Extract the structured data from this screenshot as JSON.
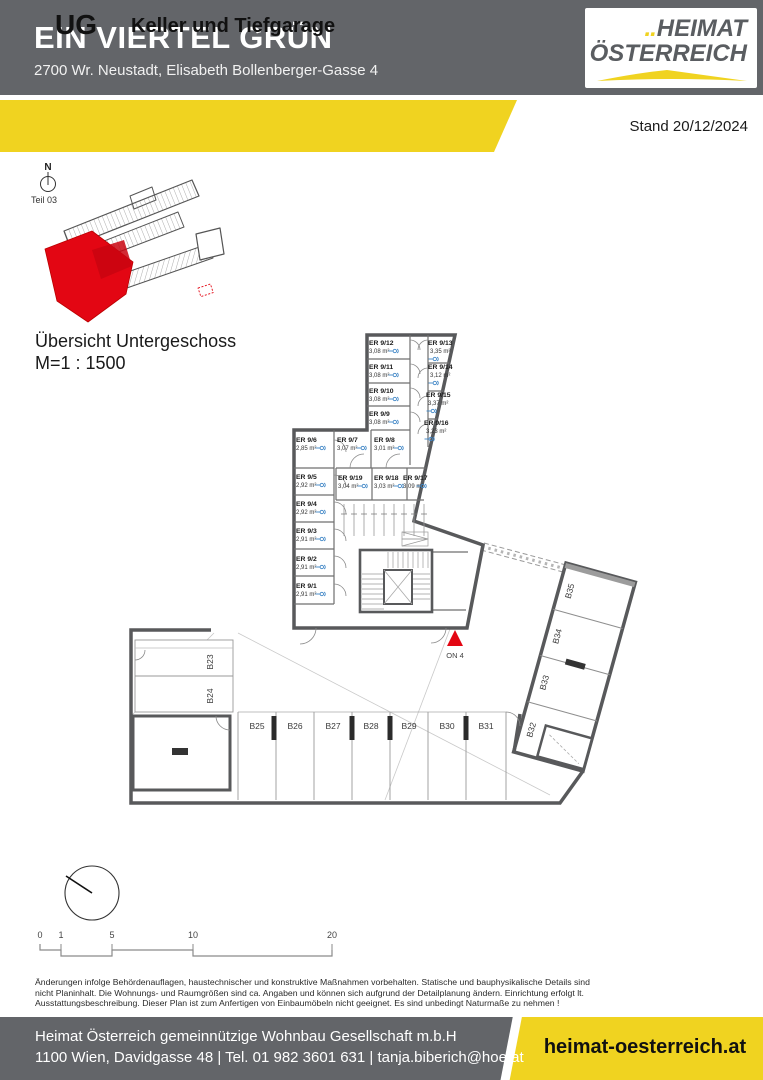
{
  "header": {
    "title": "EIN VIERTEL GRÜN",
    "address": "2700 Wr. Neustadt, Elisabeth Bollenberger-Gasse 4",
    "logo_dots": "..",
    "logo_line1": "HEIMAT",
    "logo_line2": "ÖSTERREICH"
  },
  "banner": {
    "level_code": "UG",
    "level_title": "Keller und Tiefgarage",
    "date_label": "Stand 20/12/2024"
  },
  "plan": {
    "north_label": "N",
    "part_label": "Teil 03",
    "overview_caption": "Übersicht Untergeschoss",
    "overview_scale": "M=1 : 1500",
    "marker_label": "ON 4",
    "storage_rooms": [
      {
        "name": "ER 9/1",
        "area": "2,91 m²"
      },
      {
        "name": "ER 9/2",
        "area": "2,91 m²"
      },
      {
        "name": "ER 9/3",
        "area": "2,91 m²"
      },
      {
        "name": "ER 9/4",
        "area": "2,92 m²"
      },
      {
        "name": "ER 9/5",
        "area": "2,92 m²"
      },
      {
        "name": "ER 9/6",
        "area": "2,85 m²"
      },
      {
        "name": "ER 9/7",
        "area": "3,07 m²"
      },
      {
        "name": "ER 9/8",
        "area": "3,01 m²"
      },
      {
        "name": "ER 9/9",
        "area": "3,08 m²"
      },
      {
        "name": "ER 9/10",
        "area": "3,08 m²"
      },
      {
        "name": "ER 9/11",
        "area": "3,08 m²"
      },
      {
        "name": "ER 9/12",
        "area": "3,08 m²"
      },
      {
        "name": "ER 9/13",
        "area": "3,35 m²"
      },
      {
        "name": "ER 9/14",
        "area": "3,12 m²"
      },
      {
        "name": "ER 9/15",
        "area": "3,37 m²"
      },
      {
        "name": "ER 9/16",
        "area": "3,23 m²"
      },
      {
        "name": "ER 9/17",
        "area": "3,09 m²"
      },
      {
        "name": "ER 9/18",
        "area": "3,03 m²"
      },
      {
        "name": "ER 9/19",
        "area": "3,04 m²"
      }
    ],
    "parking": [
      "B23",
      "B24",
      "B25",
      "B26",
      "B27",
      "B28",
      "B29",
      "B30",
      "B31",
      "B32",
      "B33",
      "B34",
      "B35"
    ],
    "scale_ticks": [
      "0",
      "1",
      "5",
      "10",
      "20"
    ]
  },
  "colors": {
    "accent_yellow": "#f0d320",
    "header_gray": "#636569",
    "wall_gray": "#58595b",
    "highlight_red": "#e30613",
    "symbol_blue": "#3f86c6"
  },
  "disclaimer": {
    "lines": [
      "Änderungen infolge Behördenauflagen, haustechnischer und konstruktive Maßnahmen vorbehalten. Statische und bauphysikalische Details sind",
      "nicht Planinhalt. Die Wohnungs- und Raumgrößen sind ca. Angaben und können sich aufgrund der Detailplanung ändern. Einrichtung erfolgt lt.",
      "Ausstattungsbeschreibung. Dieser Plan ist zum Anfertigen von Einbaumöbeln nicht geeignet. Es sind unbedingt Naturmaße zu nehmen !"
    ]
  },
  "footer": {
    "company": "Heimat Österreich gemeinnützige Wohnbau Gesellschaft m.b.H",
    "contact": "1100 Wien, Davidgasse 48 | Tel. 01 982 3601 631 | tanja.biberich@hoe.at",
    "website": "heimat-oesterreich.at"
  }
}
